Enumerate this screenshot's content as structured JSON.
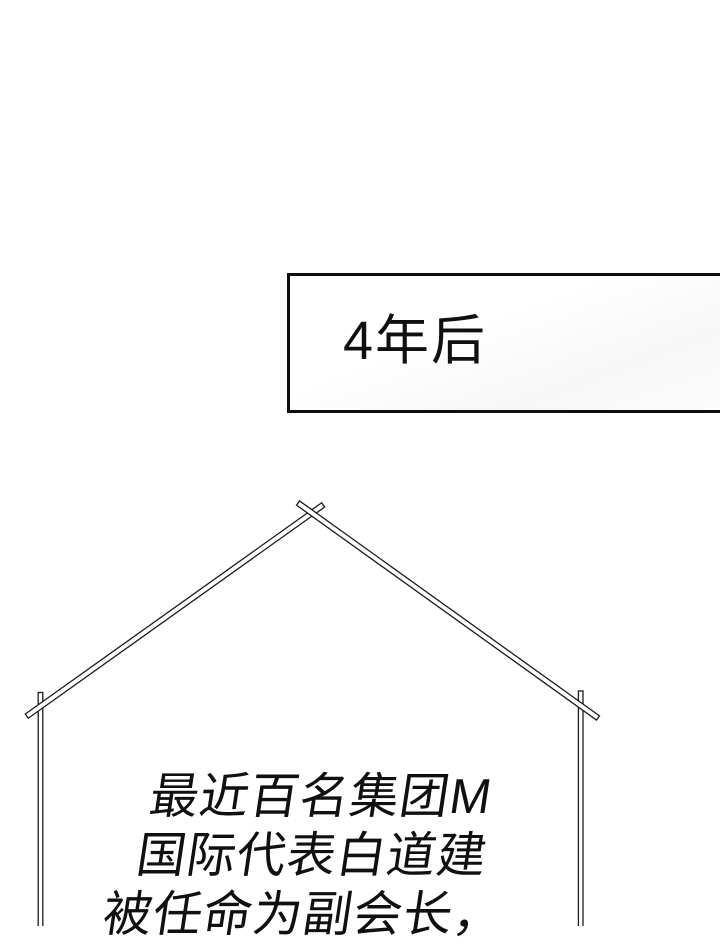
{
  "colors": {
    "paper": "#ffffff",
    "ink": "#101010",
    "line": "#1c1c1c"
  },
  "caption_box": {
    "label": "4年后"
  },
  "narration": {
    "lines": [
      "最近百名集团M",
      "国际代表白道建",
      "被任命为副会长，"
    ]
  }
}
